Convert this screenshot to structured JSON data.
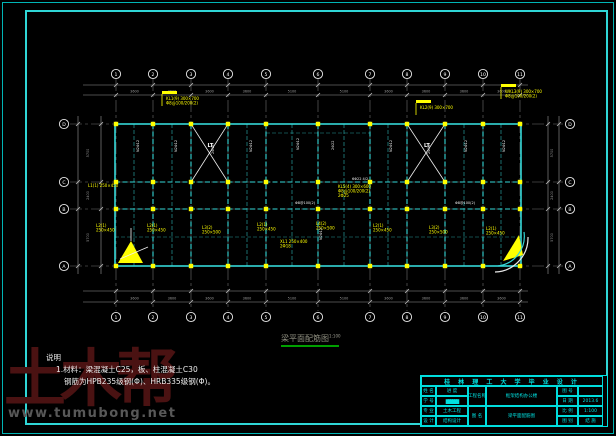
{
  "page": {
    "bg": "#000000"
  },
  "caption": {
    "text": "梁平面配筋图",
    "scale": "1:100"
  },
  "notes": {
    "heading": "说明",
    "lines": [
      "1.材料：梁混凝土C25，板、柱混凝土C30",
      "钢筋为HPB235级钢(Φ)、HRB335级钢(Φ)。"
    ]
  },
  "watermark": {
    "logo": "土木帮",
    "url": "www.tumubong.net"
  },
  "title_block": {
    "title": "桂 林 理 工 大 学 毕 业 设 计",
    "left_rows": [
      {
        "label": "姓 名",
        "value": "进 度"
      },
      {
        "label": "学 号",
        "value": "██████"
      },
      {
        "label": "专 业",
        "value": "土木工程"
      },
      {
        "label": "设 计",
        "value": "结构设计"
      }
    ],
    "mid_rows": [
      {
        "label": "工程名称",
        "value": "框架结构办公楼"
      },
      {
        "label": "图 名",
        "value": "梁平面配筋图"
      }
    ],
    "right_rows": [
      {
        "label": "图 号",
        "value": ""
      },
      {
        "label": "日 期",
        "value": "2013.6"
      },
      {
        "label": "比 例",
        "value": "1:100"
      },
      {
        "label": "图 别",
        "value": "结 施"
      }
    ]
  },
  "drawing": {
    "colors": {
      "grid": "#6f6f6f",
      "dim": "#9a9a9a",
      "beam": "#35d8d8",
      "column": "#ffff00",
      "label": "#ffff00",
      "note": "#f0f0f0"
    },
    "axes": {
      "x": {
        "pos": [
          116,
          153,
          191,
          228,
          266,
          318,
          370,
          407,
          445,
          483,
          520
        ],
        "labels": [
          "1",
          "2",
          "3",
          "4",
          "5",
          "6",
          "7",
          "8",
          "9",
          "10",
          "11"
        ],
        "grid": [
          79,
          311
        ]
      },
      "y": {
        "pos": [
          124,
          182,
          209,
          266
        ],
        "labels": [
          "D",
          "C",
          "B",
          "A"
        ],
        "grid": [
          70,
          563
        ]
      }
    },
    "dims": {
      "x": {
        "bays": [
          "3600",
          "3600",
          "3600",
          "3600",
          "5100",
          "5100",
          "3600",
          "3600",
          "3600",
          "3600"
        ],
        "ext": [
          83,
          528
        ],
        "top": {
          "lines": [
            85,
            95
          ],
          "text_y": 92.5,
          "bubble_y": 74
        },
        "bottom": {
          "lines": [
            291,
            302
          ],
          "text_y": 299.5,
          "bubble_y": 317
        }
      },
      "y": {
        "bays": [
          "5700",
          "2400",
          "5700"
        ],
        "ext": [
          116,
          274
        ],
        "left": {
          "lines": [
            78,
            101
          ],
          "text_x": 89,
          "bubble_x": 64
        },
        "right": {
          "lines": [
            548,
            559
          ],
          "text_x": 553,
          "bubble_x": 570
        }
      }
    },
    "beams": {
      "outline": {
        "x": 115,
        "y": 124,
        "w": 406,
        "h": 142
      },
      "span": [
        115,
        521
      ],
      "h_interior": [
        182,
        209
      ],
      "v_range": [
        124,
        266
      ],
      "mid_x": [
        134,
        172,
        247,
        292,
        344,
        388,
        464,
        501
      ],
      "extra": [
        {
          "x1": 266,
          "y1": 133,
          "x2": 370,
          "y2": 133
        },
        {
          "x1": 115,
          "y1": 237,
          "x2": 521,
          "y2": 237
        }
      ]
    },
    "stairs": [
      {
        "x": 191,
        "y": 124,
        "w": 37,
        "h": 58,
        "label": "LT"
      },
      {
        "x": 407,
        "y": 124,
        "w": 38,
        "h": 58,
        "label": "LT"
      }
    ],
    "beam_labels": [
      {
        "x": 166,
        "y": 100,
        "flag": true,
        "lines": [
          "KL1(9) 300×700",
          "Φ8@100/200(2)"
        ]
      },
      {
        "x": 420,
        "y": 109,
        "flag": true,
        "lines": [
          "KL2(9) 300×700"
        ]
      },
      {
        "x": 505,
        "y": 93,
        "flag": true,
        "lines": [
          "WKL3(9) 300×700",
          "Φ8@100/200(2)"
        ]
      },
      {
        "x": 88,
        "y": 187,
        "lines": [
          "L1(1) 250×450"
        ]
      },
      {
        "x": 338,
        "y": 188,
        "lines": [
          "KL5(4) 300×600",
          "Φ8@100/200(2)",
          "2Φ25"
        ]
      },
      {
        "x": 280,
        "y": 243,
        "lines": [
          "XL1 250×400",
          "2Φ18"
        ]
      },
      {
        "x": 96,
        "y": 227,
        "lines": [
          "L2(1)",
          "250×450"
        ]
      },
      {
        "x": 147,
        "y": 227,
        "lines": [
          "L2(1)",
          "250×450"
        ]
      },
      {
        "x": 202,
        "y": 229,
        "lines": [
          "L3(2)",
          "250×500"
        ]
      },
      {
        "x": 257,
        "y": 226,
        "lines": [
          "L2(1)",
          "250×450"
        ]
      },
      {
        "x": 316,
        "y": 225,
        "lines": [
          "L4(2)",
          "250×500"
        ]
      },
      {
        "x": 373,
        "y": 227,
        "lines": [
          "L2(1)",
          "250×450"
        ]
      },
      {
        "x": 429,
        "y": 229,
        "lines": [
          "L3(2)",
          "250×500"
        ]
      },
      {
        "x": 486,
        "y": 230,
        "lines": [
          "L2(1)",
          "250×450"
        ]
      }
    ],
    "rebar_notes": [
      {
        "x": 139,
        "y": 152,
        "t": "N2Φ12",
        "v": true
      },
      {
        "x": 177,
        "y": 152,
        "t": "N2Φ12",
        "v": true
      },
      {
        "x": 214,
        "y": 154,
        "t": "2Φ16",
        "v": true
      },
      {
        "x": 252,
        "y": 152,
        "t": "N2Φ12",
        "v": true
      },
      {
        "x": 299,
        "y": 150,
        "t": "N2Φ12",
        "v": true
      },
      {
        "x": 334,
        "y": 150,
        "t": "2Φ22",
        "v": true
      },
      {
        "x": 392,
        "y": 152,
        "t": "N2Φ12",
        "v": true
      },
      {
        "x": 430,
        "y": 154,
        "t": "2Φ16",
        "v": true
      },
      {
        "x": 467,
        "y": 152,
        "t": "N2Φ12",
        "v": true
      },
      {
        "x": 505,
        "y": 152,
        "t": "N2Φ12",
        "v": true
      },
      {
        "x": 322,
        "y": 240,
        "t": "N2Φ12",
        "v": true
      },
      {
        "x": 352,
        "y": 180,
        "t": "6Φ22 4/2"
      },
      {
        "x": 295,
        "y": 204,
        "t": "Φ8@100(2)"
      },
      {
        "x": 455,
        "y": 204,
        "t": "Φ8@100(2)"
      },
      {
        "x": 120,
        "y": 261,
        "t": "2Φ25"
      }
    ],
    "extras": {
      "triangles": [
        {
          "points": "118,263 131,241 143,263"
        },
        {
          "points": "503,261 519,235 523,255"
        }
      ],
      "arcs": [
        {
          "d": "M 498,266 A 30 30 0 0 0 524,232",
          "stroke": "#35d8d8"
        },
        {
          "d": "M 495,272 A 34 34 0 0 0 528,237",
          "stroke": "#e8e8e8"
        }
      ],
      "lines": [
        {
          "x1": 148,
          "y1": 247,
          "x2": 120,
          "y2": 259
        },
        {
          "x1": 131,
          "y1": 241,
          "x2": 131,
          "y2": 228
        }
      ]
    }
  }
}
